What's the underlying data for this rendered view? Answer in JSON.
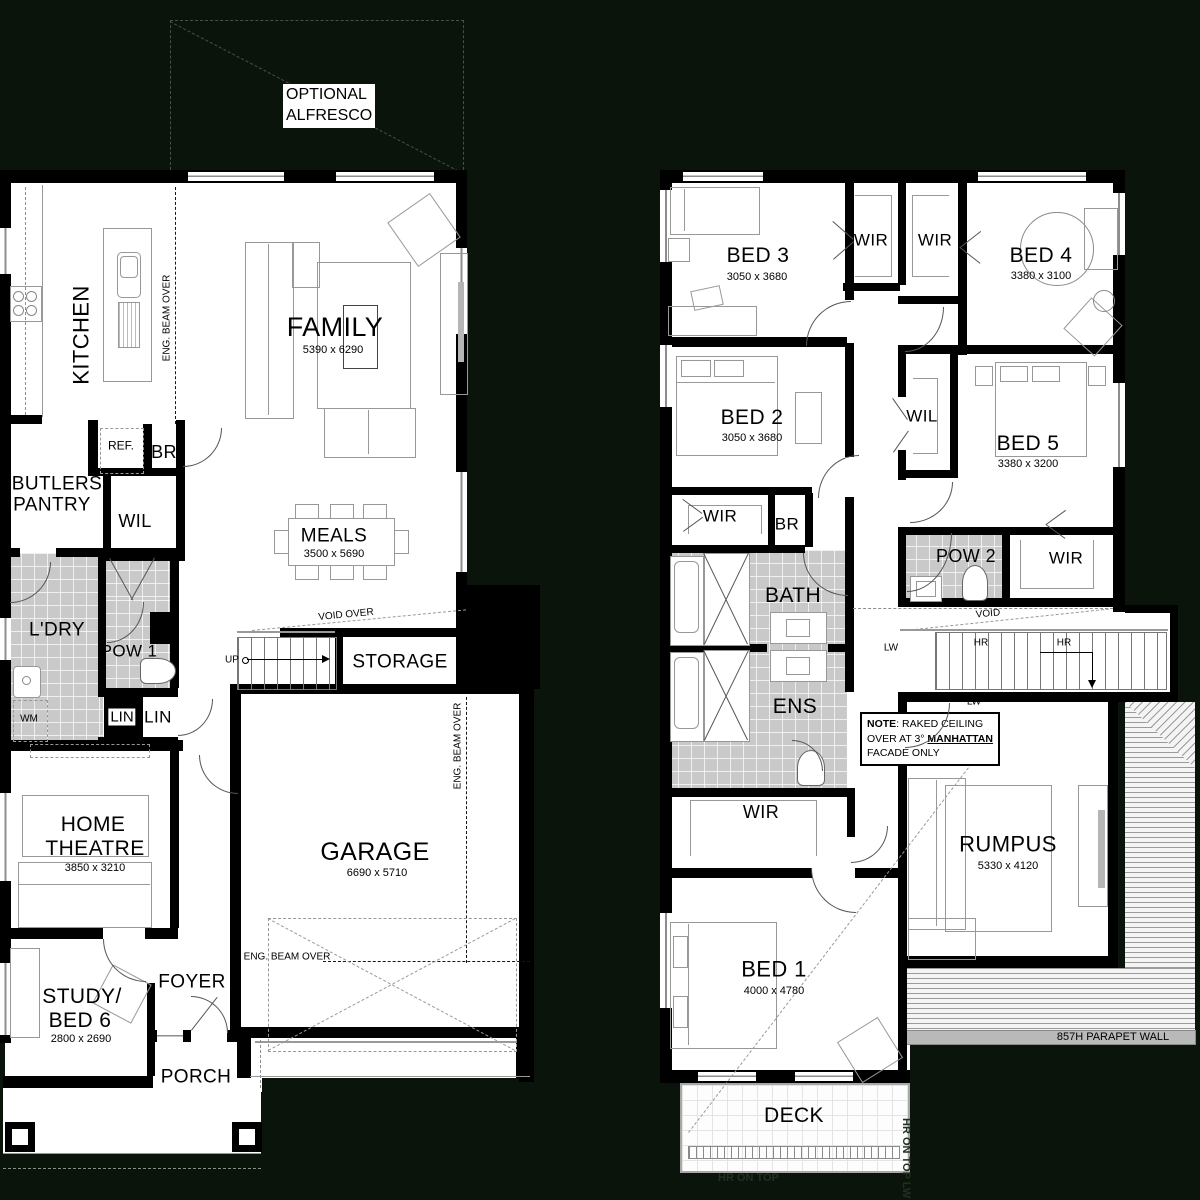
{
  "ground_floor": {
    "rooms": {
      "kitchen": {
        "name": "KITCHEN"
      },
      "family": {
        "name": "FAMILY",
        "dims": "5390 x 6290"
      },
      "butlers": {
        "name1": "BUTLERS",
        "name2": "PANTRY"
      },
      "ref": {
        "name": "REF."
      },
      "br": {
        "name": "BR"
      },
      "wil": {
        "name": "WIL"
      },
      "meals": {
        "name": "MEALS",
        "dims": "3500 x 5690"
      },
      "ldry": {
        "name": "L'DRY"
      },
      "pow1": {
        "name": "POW 1"
      },
      "lin1": {
        "name": "LIN"
      },
      "lin2": {
        "name": "LIN"
      },
      "storage": {
        "name": "STORAGE"
      },
      "theatre": {
        "name1": "HOME",
        "name2": "THEATRE",
        "dims": "3850 x 3210"
      },
      "garage": {
        "name": "GARAGE",
        "dims": "6690 x 5710"
      },
      "study": {
        "name1": "STUDY/",
        "name2": "BED 6",
        "dims": "2800 x 2690"
      },
      "foyer": {
        "name": "FOYER"
      },
      "porch": {
        "name": "PORCH"
      }
    },
    "annotations": {
      "alfresco1": "OPTIONAL",
      "alfresco2": "ALFRESCO",
      "beam_kitchen": "ENG. BEAM OVER",
      "beam_garage_v": "ENG. BEAM OVER",
      "beam_garage_h": "ENG. BEAM OVER",
      "void_over": "VOID OVER",
      "up": "UP",
      "wm": "WM"
    }
  },
  "upper_floor": {
    "rooms": {
      "bed1": {
        "name": "BED 1",
        "dims": "4000 x 4780"
      },
      "bed2": {
        "name": "BED 2",
        "dims": "3050 x 3680"
      },
      "bed3": {
        "name": "BED 3",
        "dims": "3050 x 3680"
      },
      "bed4": {
        "name": "BED 4",
        "dims": "3380 x 3100"
      },
      "bed5": {
        "name": "BED 5",
        "dims": "3380 x 3200"
      },
      "wir1": {
        "name": "WIR"
      },
      "wir2": {
        "name": "WIR"
      },
      "wil": {
        "name": "WIL"
      },
      "wir3": {
        "name": "WIR"
      },
      "br": {
        "name": "BR"
      },
      "pow2": {
        "name": "POW 2"
      },
      "wir4": {
        "name": "WIR"
      },
      "bath": {
        "name": "BATH"
      },
      "ens": {
        "name": "ENS"
      },
      "wir5": {
        "name": "WIR"
      },
      "rumpus": {
        "name": "RUMPUS",
        "dims": "5330 x 4120"
      },
      "deck": {
        "name": "DECK"
      }
    },
    "annotations": {
      "void": "VOID",
      "lw_left": "LW",
      "lw_bottom": "LW",
      "hr_left": "HR",
      "hr_right": "HR",
      "note_title": "NOTE",
      "note_rest1": ": RAKED CEILING",
      "note_rest2": "OVER AT 3° ",
      "note_manhattan": "MANHATTAN",
      "note_rest3": "FACADE ONLY",
      "parapet": "857H PARAPET WALL",
      "hr_on_top": "HR ON TOP",
      "hr_on_top_lw": "HR ON TOP LW"
    }
  }
}
